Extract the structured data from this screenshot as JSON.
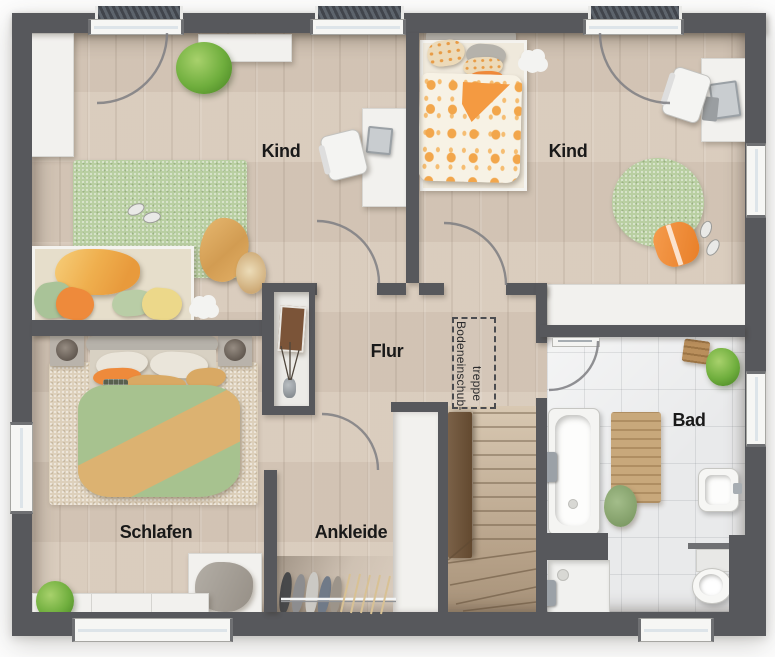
{
  "floorplan": {
    "title_hint": "upper floor plan",
    "rooms": [
      {
        "id": "kind-left",
        "label": "Kind"
      },
      {
        "id": "kind-right",
        "label": "Kind"
      },
      {
        "id": "flur",
        "label": "Flur"
      },
      {
        "id": "schlafen",
        "label": "Schlafen"
      },
      {
        "id": "ankleide",
        "label": "Ankleide"
      },
      {
        "id": "bad",
        "label": "Bad"
      }
    ],
    "annotation": {
      "attic_hatch_line1": "Bodeneinschub-",
      "attic_hatch_line2": "treppe"
    },
    "colors": {
      "wall": "#57585c",
      "wood_floor": "#d8cabb",
      "tile_floor": "#e9eaeb",
      "rug_green": "#b9cfa2",
      "accent_orange": "#ef8b3c",
      "duvet_green": "#a7c28f",
      "duvet_tan": "#dcb271",
      "stairs_wood": "#cdbca8",
      "balustrade_wood": "#6e5640",
      "plant_green": "#6fae3d"
    }
  }
}
